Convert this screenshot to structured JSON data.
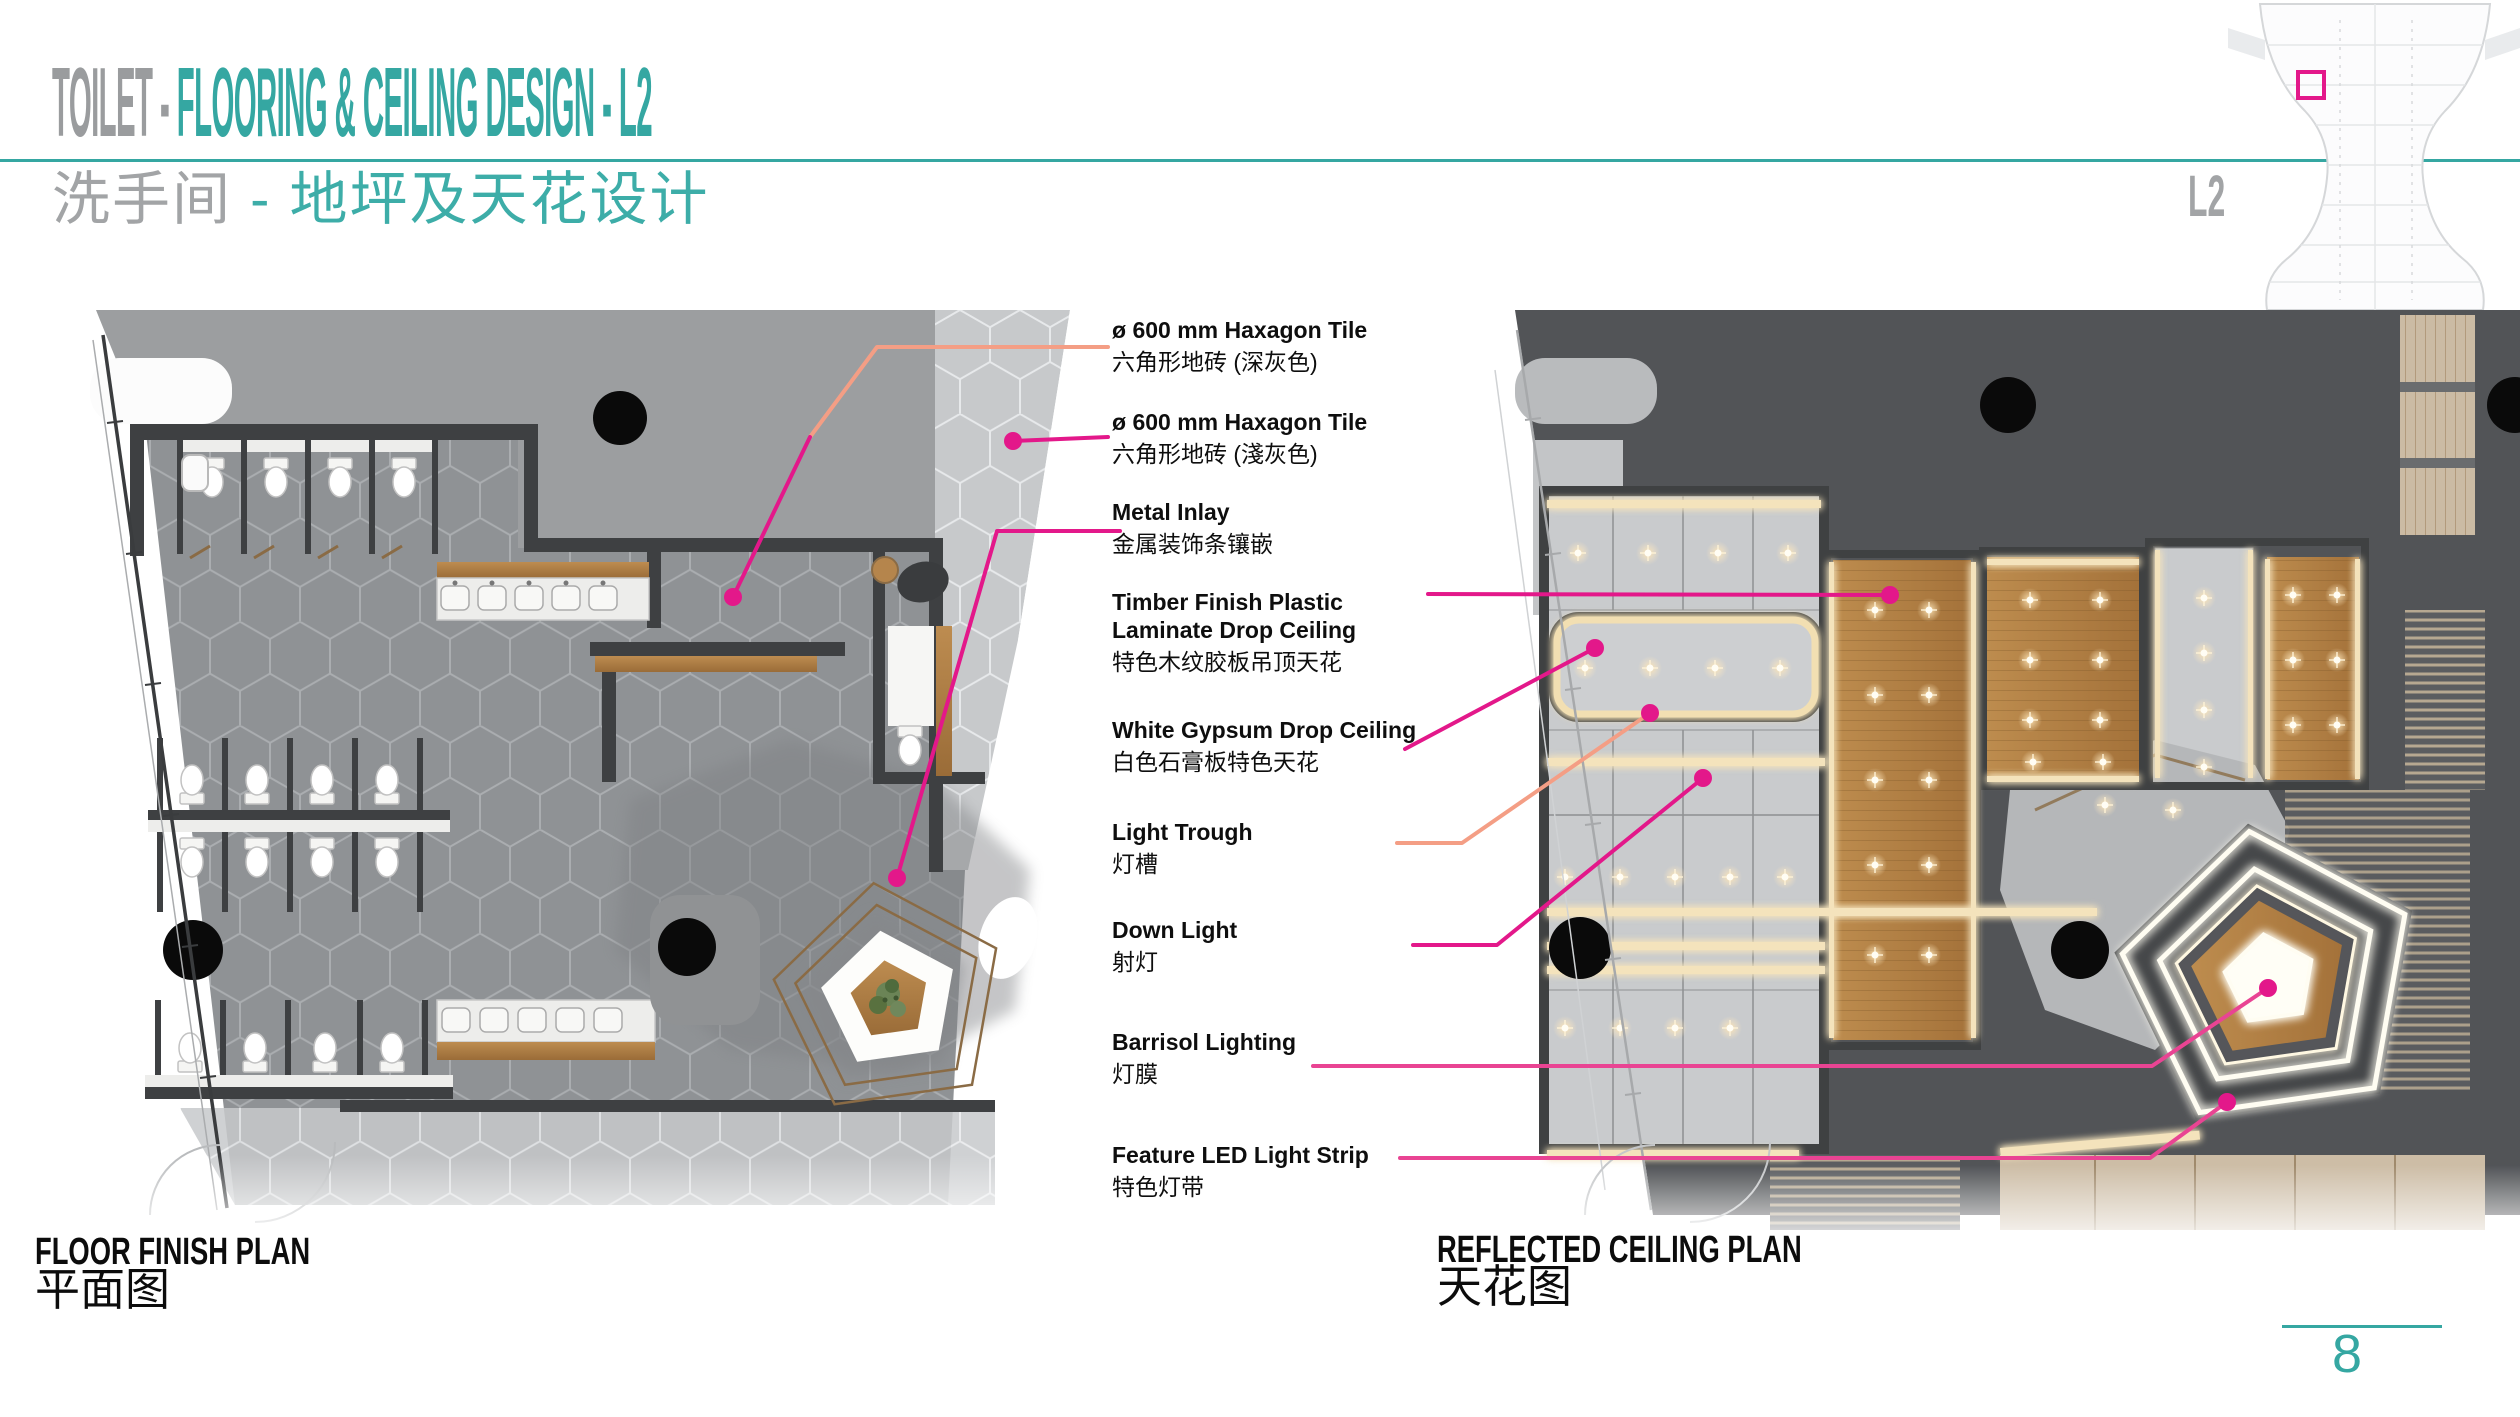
{
  "header": {
    "title_gray": "TOILET - ",
    "title_teal": "FLOORING & CEILING DESIGN - L2",
    "subtitle_gray": "洗手间 ",
    "subtitle_teal": "- 地坪及天花设计"
  },
  "keyplan": {
    "level": "L2"
  },
  "annotations": [
    {
      "en": "ø 600 mm Haxagon Tile",
      "zh": "六角形地砖 (深灰色)",
      "leader_color": "salmon"
    },
    {
      "en": "ø 600 mm Haxagon Tile",
      "zh": "六角形地砖 (淺灰色)",
      "leader_color": "magenta"
    },
    {
      "en": "Metal Inlay",
      "zh": "金属装饰条镶嵌",
      "leader_color": "magenta"
    },
    {
      "en": "Timber Finish Plastic",
      "en2": "Laminate Drop Ceiling",
      "zh": "特色木纹胶板吊顶天花",
      "leader_color": "magenta"
    },
    {
      "en": "White Gypsum Drop Ceiling",
      "zh": "白色石膏板特色天花",
      "leader_color": "magenta"
    },
    {
      "en": "Light Trough",
      "zh": "灯槽",
      "leader_color": "salmon"
    },
    {
      "en": "Down Light",
      "zh": "射灯",
      "leader_color": "magenta"
    },
    {
      "en": "Barrisol Lighting",
      "zh": "灯膜",
      "leader_color": "magenta"
    },
    {
      "en": "Feature LED Light Strip",
      "zh": "特色灯带",
      "leader_color": "magenta"
    }
  ],
  "plans": {
    "floor": {
      "title": "FLOOR FINISH PLAN",
      "subtitle": "平面图"
    },
    "ceiling": {
      "title": "REFLECTED CEILING PLAN",
      "subtitle": "天花图"
    }
  },
  "footer": {
    "page_number": "8"
  },
  "colors": {
    "teal": "#35a7a2",
    "magenta": "#e3188a",
    "salmon": "#f49e85",
    "wall_dark": "#3e4042",
    "charcoal_bg": "#525457",
    "hex_tile_dark": "#8f9295",
    "hex_tile_light": "#c7c9cb",
    "gypsum": "#c9cbcd",
    "timber": "#b5854c",
    "light_glow": "#f4e3bc"
  }
}
